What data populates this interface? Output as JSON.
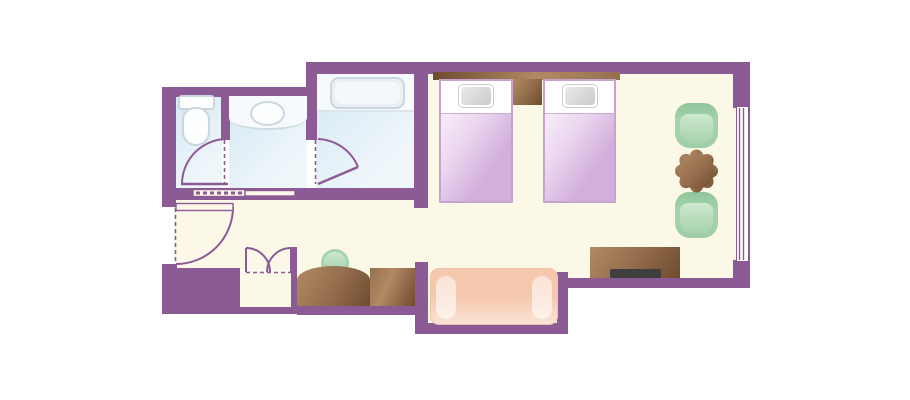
{
  "scene": "hotel-guest-room-floor-plan",
  "palette": {
    "wall": "#8C5B96",
    "floor": "#FCF8E7",
    "bath_floor_light": "#EEF6FA",
    "bath_floor_deep": "#D5E8F3",
    "bath_white": "#F6FAFC",
    "fixture_line": "#C9D7DE",
    "fixture_fill": "#FDFEFE",
    "tub_fill": "#E9EFF3",
    "bed_border": "#C8A3CE",
    "bed_sheet": "#FFFFFF",
    "blanket_light": "#F6ECF8",
    "blanket_deep": "#D3B0DC",
    "pillow_light": "#EAEAEA",
    "pillow_deep": "#CBCBCB",
    "wood_light": "#B18A63",
    "wood_mid": "#96704E",
    "wood_dark": "#6F4A2F",
    "chair_light": "#CDE8CF",
    "chair_mid": "#A6D3AB",
    "chair_mid2": "#9FCEa6",
    "chair_deep": "#8FC69B",
    "sofa_mid": "#F6C9AE",
    "sofa_light": "#FBE3D6",
    "tv": "#3F3F3F",
    "window_glass": "#FFFFFF"
  },
  "architecture": {
    "walls": "purple-walls",
    "window": "window-right-wall",
    "entry_door": "entry-swing-door",
    "bathroom_sliding_door": "bathroom-sliding-door",
    "toilet_door": "toilet-swing-door",
    "bath_door": "bathtub-room-swing-door",
    "closet": "closet-double-doors"
  },
  "furniture": [
    "toilet",
    "vanity-sink",
    "bathtub",
    "headboard",
    "twin-bed-1",
    "twin-bed-2",
    "nightstand",
    "armchair-upper",
    "round-table",
    "armchair-lower",
    "tv-dresser",
    "tv",
    "sofa",
    "vanity-counter",
    "stool",
    "luggage-rack"
  ]
}
